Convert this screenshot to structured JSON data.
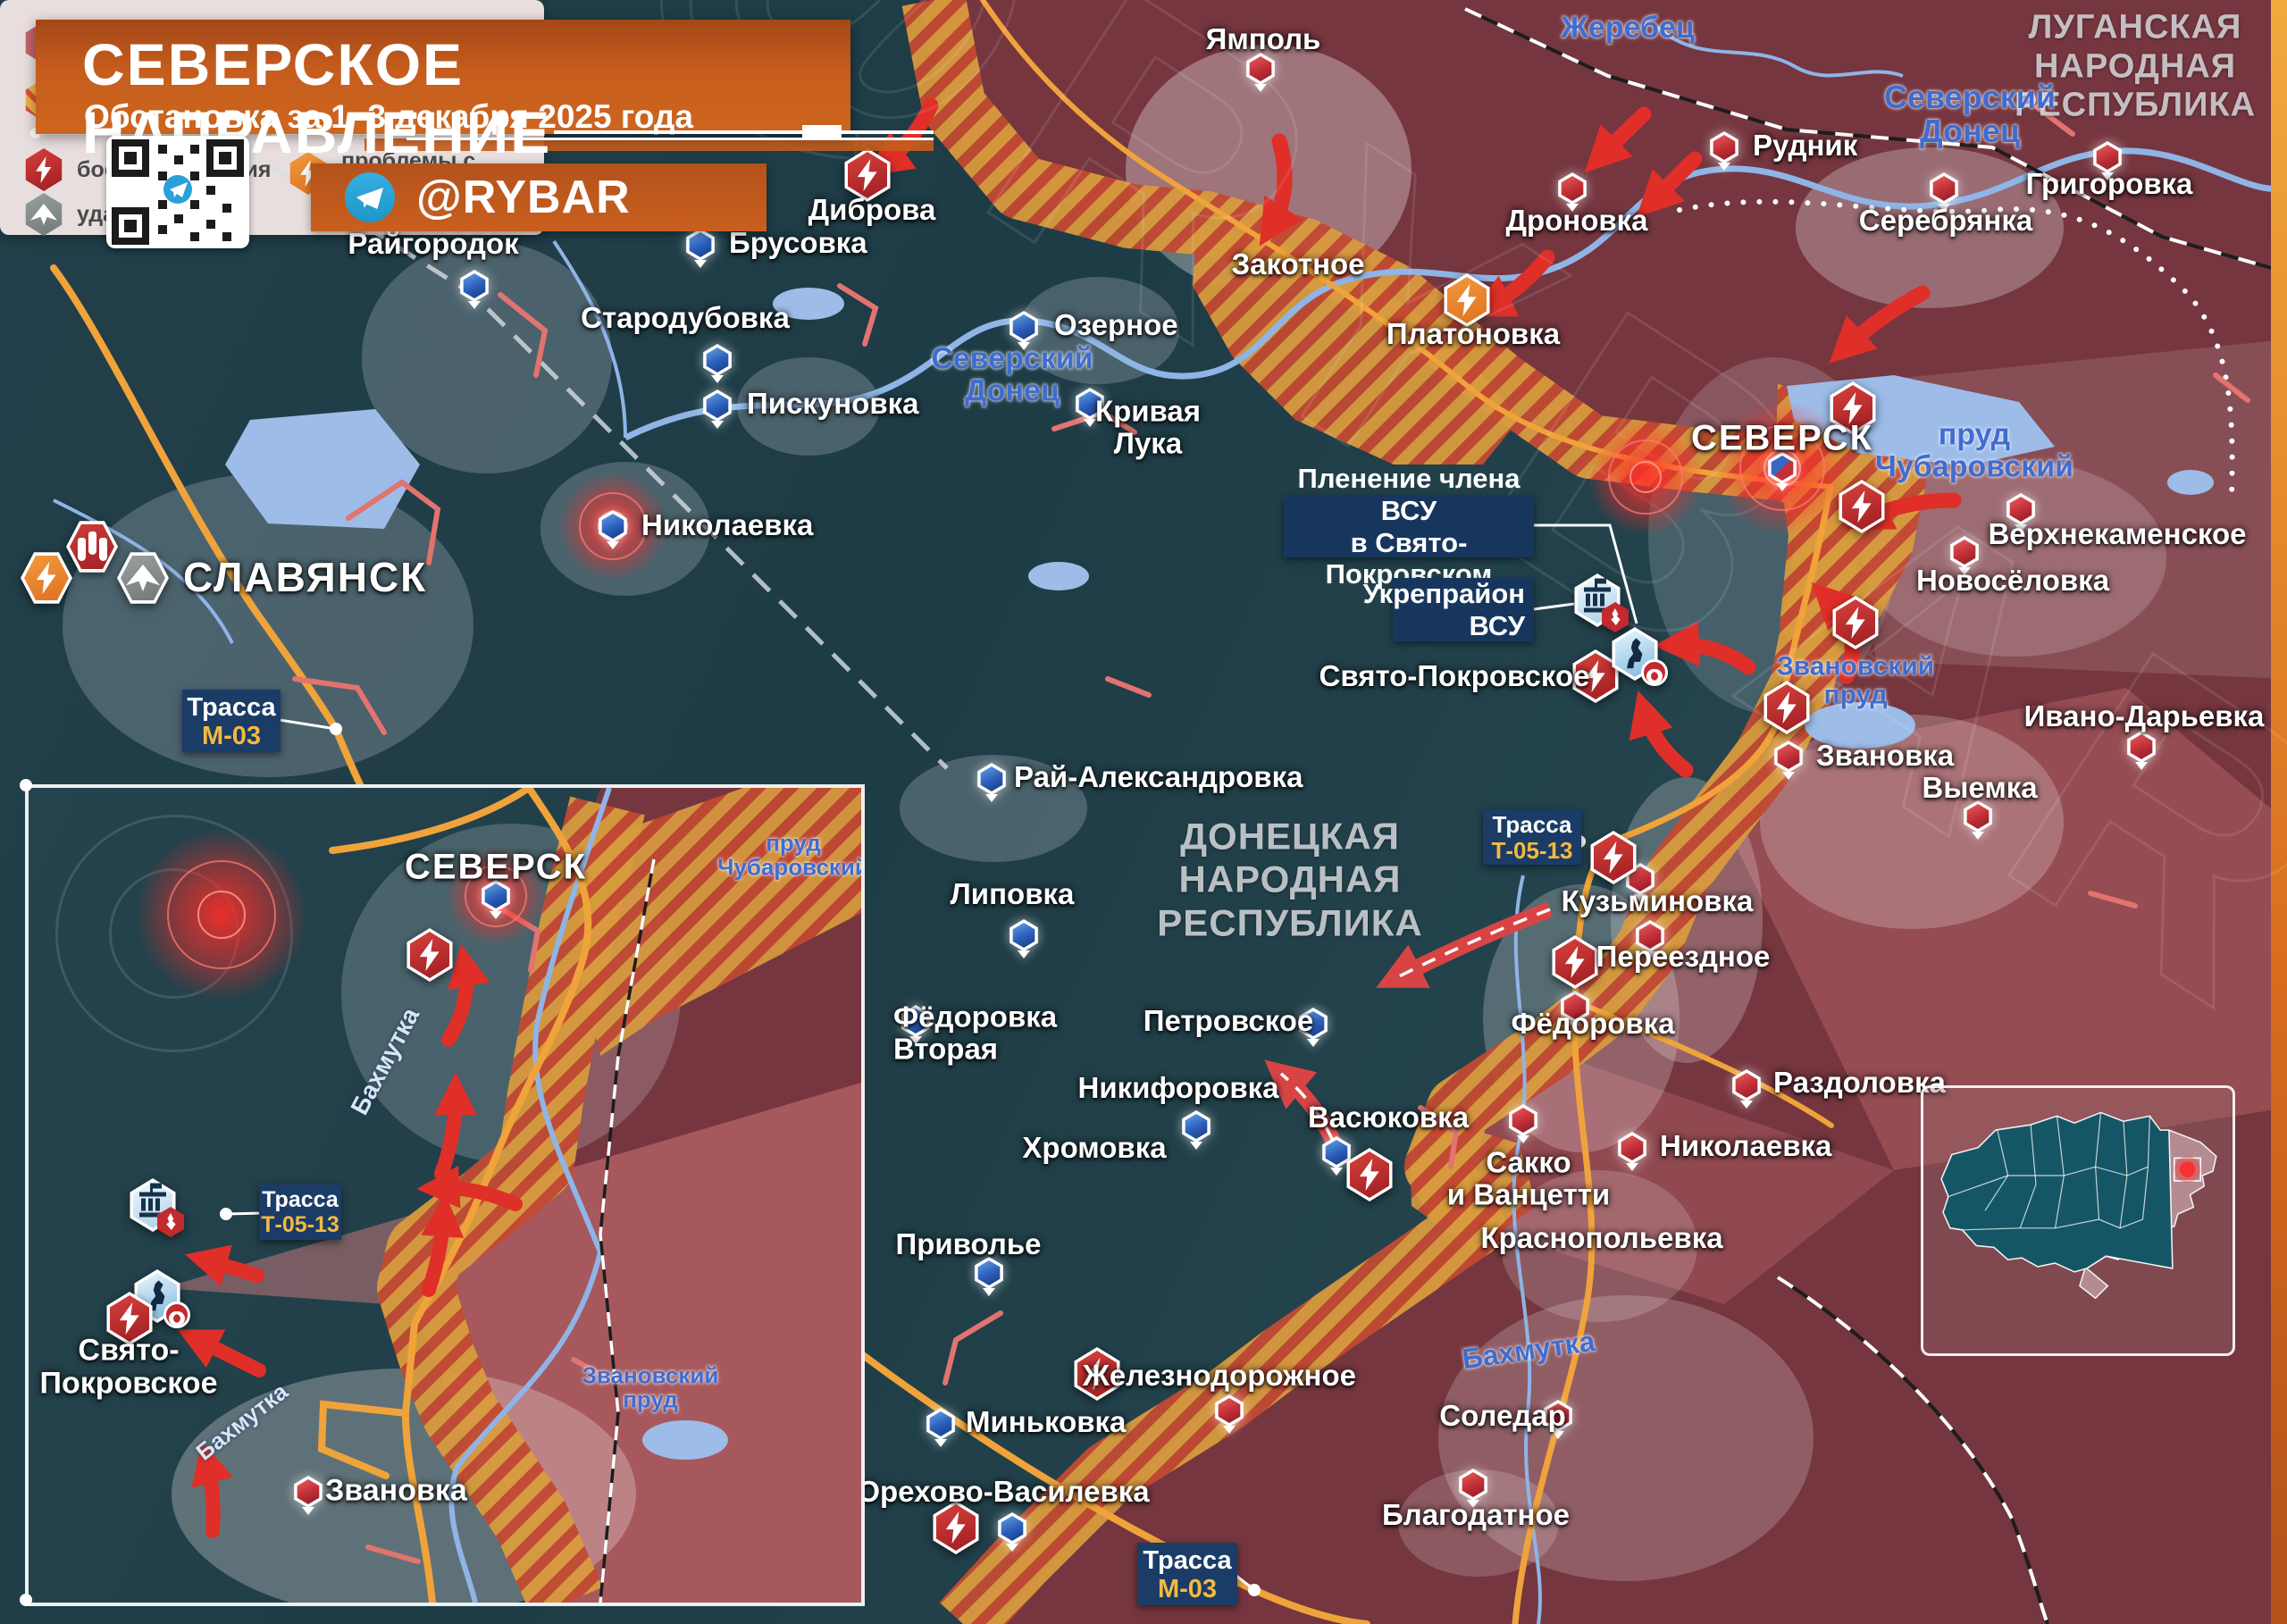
{
  "header": {
    "title": "СЕВЕРСКОЕ НАПРАВЛЕНИЕ",
    "subtitle": "Обстановка за 1–3 декабря 2025 года",
    "channel": "@RYBAR"
  },
  "watermark": "@RYBAR",
  "regions": {
    "lnr": "ЛУГАНСКАЯ\nНАРОДНАЯ\nРЕСПУБЛИКА",
    "dnr": "ДОНЕЦКАЯ\nНАРОДНАЯ\nРЕСПУБЛИКА"
  },
  "water": {
    "donets": "Северский\nДонец",
    "zherebets": "Жеребец",
    "chub": "пруд\nЧубаровский",
    "zvan": "Звановский\nпруд",
    "bakhmutka": "Бахмутка"
  },
  "roads": {
    "t": "Трасса",
    "m03": "М-03",
    "t0513": "Т-05-13"
  },
  "callouts": {
    "capture": "Пленение члена ВСУ\nв Свято-Покровском",
    "ukrep": "Укрепрайон\nВСУ"
  },
  "s": [
    "Райгородок",
    "Брусовка",
    "Стародубовка",
    "Пискуновка",
    "Озерное",
    "Кривая Лука",
    "Николаевка",
    "СЛАВЯНСК",
    "Рай-Александровка",
    "Липовка",
    "Фёдоровка\nВторая",
    "Петровское",
    "Никифоровка",
    "Васюковка",
    "Хромовка",
    "Приволье",
    "Миньковка",
    "Орехово-Василевка",
    "Ямполь",
    "Диброва",
    "Закотное",
    "Дроновка",
    "Платоновка",
    "Рудник",
    "Григоровка",
    "Серебрянка",
    "СЕВЕРСК",
    "Верхнекаменское",
    "Новосёловка",
    "Звановка",
    "Выемка",
    "Ивано-Дарьевка",
    "Кузьминовка",
    "Переездное",
    "Фёдоровка",
    "Раздоловка",
    "Николаевка",
    "Сакко\nи Ванцетти",
    "Краснопольевка",
    "Соледар",
    "Благодатное",
    "Железнодорожное",
    "Свято-Покровское"
  ],
  "inset": {
    "s": [
      "СЕВЕРСК",
      "Свято-\nПокровское",
      "Звановка"
    ]
  },
  "legend": {
    "items": [
      "территориальный контроль сил РФ",
      "территориальный контроль украинских сил",
      "территория боевых действий",
      "укрепрайон",
      "боестолкновения",
      "проблемы с электроснабжением",
      "удар БЛА"
    ]
  },
  "colors": {
    "rf_zone": "#75363f",
    "ua_zone": "#23424c",
    "combat_zone_hatch": "#d8543a",
    "rf_marker": "#bf2d35",
    "ua_marker": "#2a5cb8",
    "battle": "#c0392b",
    "power": "#e8842c",
    "drone": "#8a9090",
    "road": "#f0a33a",
    "callout": "#17365e"
  }
}
